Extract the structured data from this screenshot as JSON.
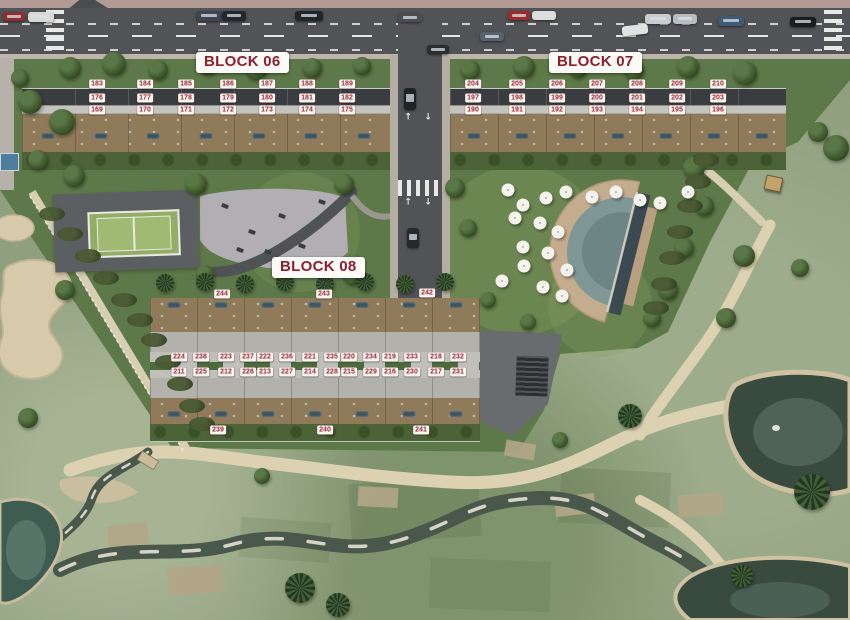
{
  "blocks": [
    {
      "id": "block-06",
      "label": "BLOCK 06"
    },
    {
      "id": "block-07",
      "label": "BLOCK 07"
    },
    {
      "id": "block-08",
      "label": "BLOCK 08"
    }
  ],
  "plots": {
    "block06": {
      "tag_y": [
        84,
        98,
        110
      ],
      "cols": [
        97,
        145,
        186,
        228,
        267,
        307,
        347
      ],
      "rows": [
        [
          "183",
          "184",
          "185",
          "186",
          "187",
          "188",
          "189"
        ],
        [
          "176",
          "177",
          "178",
          "179",
          "180",
          "181",
          "182"
        ],
        [
          "169",
          "170",
          "171",
          "172",
          "173",
          "174",
          "175"
        ]
      ]
    },
    "block07": {
      "tag_y": [
        84,
        98,
        110
      ],
      "cols": [
        473,
        517,
        557,
        597,
        637,
        677,
        718
      ],
      "rows": [
        [
          "204",
          "205",
          "206",
          "207",
          "208",
          "209",
          "210"
        ],
        [
          "197",
          "198",
          "199",
          "200",
          "201",
          "202",
          "203"
        ],
        [
          "190",
          "191",
          "192",
          "193",
          "194",
          "195",
          "196"
        ]
      ]
    },
    "block08": {
      "pair_cols": [
        190,
        237,
        276,
        321,
        360,
        401,
        447
      ],
      "pair_rows": [
        {
          "y": 357,
          "pairs": [
            [
              "224",
              "238"
            ],
            [
              "223",
              "237"
            ],
            [
              "222",
              "236"
            ],
            [
              "221",
              "235"
            ],
            [
              "220",
              "234"
            ],
            [
              "219",
              "233"
            ],
            [
              "218",
              "232"
            ]
          ]
        },
        {
          "y": 372,
          "pairs": [
            [
              "211",
              "225"
            ],
            [
              "212",
              "226"
            ],
            [
              "213",
              "227"
            ],
            [
              "214",
              "228"
            ],
            [
              "215",
              "229"
            ],
            [
              "216",
              "230"
            ],
            [
              "217",
              "231"
            ]
          ]
        }
      ],
      "top_tags": [
        {
          "v": "244",
          "x": 222,
          "y": 294
        },
        {
          "v": "243",
          "x": 324,
          "y": 294
        },
        {
          "v": "242",
          "x": 427,
          "y": 293
        }
      ],
      "bottom_tags": [
        {
          "v": "239",
          "x": 218,
          "y": 430
        },
        {
          "v": "240",
          "x": 325,
          "y": 430
        },
        {
          "v": "241",
          "x": 421,
          "y": 430
        }
      ]
    }
  },
  "icons": {
    "up_arrow": "↑",
    "down_arrow": "↓"
  },
  "colors": {
    "tag_text": "#a02837",
    "tag_bg": "#f7f5f0",
    "label_text": "#8e1f2f",
    "label_bg": "#fbfaf6",
    "asphalt": "#515356",
    "golf_green": "#90a07f",
    "dev_lawn": "#5e7949",
    "sand": "#d6caab",
    "pond_water": "#394a3e",
    "pool_deck": "#c4ad8e",
    "terrace_deck": "#8f7a59"
  },
  "scenery": {
    "trees": [
      [
        70,
        68,
        11
      ],
      [
        114,
        64,
        12
      ],
      [
        158,
        70,
        10
      ],
      [
        208,
        66,
        9
      ],
      [
        256,
        69,
        11
      ],
      [
        312,
        68,
        10
      ],
      [
        362,
        66,
        9
      ],
      [
        470,
        70,
        10
      ],
      [
        524,
        67,
        11
      ],
      [
        578,
        69,
        9
      ],
      [
        634,
        70,
        10
      ],
      [
        688,
        67,
        11
      ],
      [
        745,
        73,
        12
      ],
      [
        30,
        102,
        12
      ],
      [
        62,
        122,
        13
      ],
      [
        38,
        160,
        10
      ],
      [
        74,
        176,
        11
      ],
      [
        20,
        78,
        9
      ],
      [
        196,
        184,
        11
      ],
      [
        344,
        184,
        10
      ],
      [
        205,
        274,
        9
      ],
      [
        352,
        276,
        9
      ],
      [
        455,
        188,
        10
      ],
      [
        468,
        228,
        9
      ],
      [
        694,
        168,
        11
      ],
      [
        704,
        206,
        10
      ],
      [
        684,
        248,
        10
      ],
      [
        668,
        290,
        10
      ],
      [
        652,
        318,
        9
      ],
      [
        836,
        148,
        13
      ],
      [
        818,
        132,
        10
      ],
      [
        726,
        318,
        10
      ],
      [
        744,
        256,
        11
      ],
      [
        800,
        268,
        9
      ],
      [
        65,
        290,
        10
      ],
      [
        28,
        418,
        10
      ],
      [
        262,
        476,
        8
      ],
      [
        560,
        440,
        8
      ],
      [
        488,
        300,
        8
      ],
      [
        528,
        322,
        8
      ]
    ],
    "palms": [
      [
        165,
        283,
        9
      ],
      [
        205,
        282,
        9
      ],
      [
        245,
        284,
        9
      ],
      [
        285,
        282,
        9
      ],
      [
        325,
        284,
        9
      ],
      [
        365,
        282,
        9
      ],
      [
        405,
        284,
        9
      ],
      [
        445,
        282,
        9
      ],
      [
        300,
        588,
        15
      ],
      [
        338,
        605,
        12
      ],
      [
        630,
        416,
        12
      ],
      [
        812,
        492,
        18
      ],
      [
        742,
        576,
        11
      ]
    ],
    "hedges": [
      [
        52,
        214
      ],
      [
        70,
        234
      ],
      [
        88,
        256
      ],
      [
        106,
        278
      ],
      [
        124,
        300
      ],
      [
        140,
        320
      ],
      [
        154,
        340
      ],
      [
        168,
        362
      ],
      [
        180,
        384
      ],
      [
        192,
        406
      ],
      [
        202,
        424
      ],
      [
        706,
        160
      ],
      [
        698,
        182
      ],
      [
        690,
        206
      ],
      [
        680,
        232
      ],
      [
        672,
        258
      ],
      [
        664,
        284
      ],
      [
        656,
        308
      ]
    ],
    "cars": [
      [
        3,
        12,
        22,
        9,
        "#8c2f2f",
        0
      ],
      [
        28,
        12,
        26,
        10,
        "#d9d9d7",
        0
      ],
      [
        196,
        11,
        26,
        10,
        "#3c4550",
        0
      ],
      [
        222,
        11,
        24,
        10,
        "#24272b",
        0
      ],
      [
        295,
        11,
        28,
        10,
        "#212428",
        0
      ],
      [
        398,
        13,
        24,
        9,
        "#4a4e52",
        0
      ],
      [
        508,
        11,
        22,
        9,
        "#9c2b2b",
        0
      ],
      [
        532,
        11,
        24,
        9,
        "#dddddb",
        0
      ],
      [
        645,
        14,
        26,
        10,
        "#caccce",
        0
      ],
      [
        673,
        14,
        24,
        10,
        "#b9bcbe",
        0
      ],
      [
        718,
        16,
        26,
        10,
        "#3e5a74",
        0
      ],
      [
        790,
        17,
        26,
        10,
        "#1a1c1e",
        0
      ],
      [
        622,
        25,
        26,
        10,
        "#e3e3e1",
        -7
      ],
      [
        480,
        32,
        24,
        9,
        "#55606c",
        0
      ],
      [
        427,
        45,
        22,
        9,
        "#2b2e31",
        0
      ],
      [
        404,
        88,
        12,
        22,
        "#1f2224",
        0
      ],
      [
        407,
        228,
        12,
        20,
        "#26292c",
        0
      ]
    ],
    "umbrellas": [
      [
        508,
        190
      ],
      [
        523,
        205
      ],
      [
        546,
        198
      ],
      [
        566,
        192
      ],
      [
        592,
        197
      ],
      [
        616,
        192
      ],
      [
        640,
        200
      ],
      [
        660,
        203
      ],
      [
        688,
        192
      ],
      [
        515,
        218
      ],
      [
        540,
        223
      ],
      [
        558,
        232
      ],
      [
        523,
        247
      ],
      [
        548,
        253
      ],
      [
        567,
        270
      ],
      [
        524,
        266
      ],
      [
        502,
        281
      ],
      [
        543,
        287
      ],
      [
        562,
        296
      ]
    ],
    "unit_pools": [
      {
        "y": 136,
        "xs": [
          48,
          101,
          153,
          206,
          259,
          311,
          364
        ]
      },
      {
        "y": 136,
        "xs": [
          474,
          522,
          570,
          618,
          666,
          714,
          762
        ]
      },
      {
        "y": 305,
        "xs": [
          174,
          221,
          268,
          315,
          362,
          409,
          456
        ]
      },
      {
        "y": 414,
        "xs": [
          174,
          221,
          268,
          315,
          362,
          409,
          456
        ]
      }
    ],
    "equipment": [
      [
        225,
        206
      ],
      [
        252,
        232
      ],
      [
        282,
        216
      ],
      [
        302,
        246
      ],
      [
        322,
        202
      ],
      [
        268,
        252
      ],
      [
        240,
        250
      ]
    ],
    "road_arrows": [
      [
        408,
        118,
        "up"
      ],
      [
        428,
        118,
        "down"
      ],
      [
        408,
        203,
        "up"
      ],
      [
        428,
        203,
        "down"
      ]
    ],
    "bridge": {
      "x": 138,
      "y": 455,
      "w": 20,
      "h": 11,
      "rot": 32
    },
    "hut": {
      "x": 765,
      "y": 176,
      "w": 17,
      "h": 15,
      "rot": 12
    },
    "side_pool": {
      "x": 0,
      "y": 153,
      "w": 19,
      "h": 18
    }
  }
}
